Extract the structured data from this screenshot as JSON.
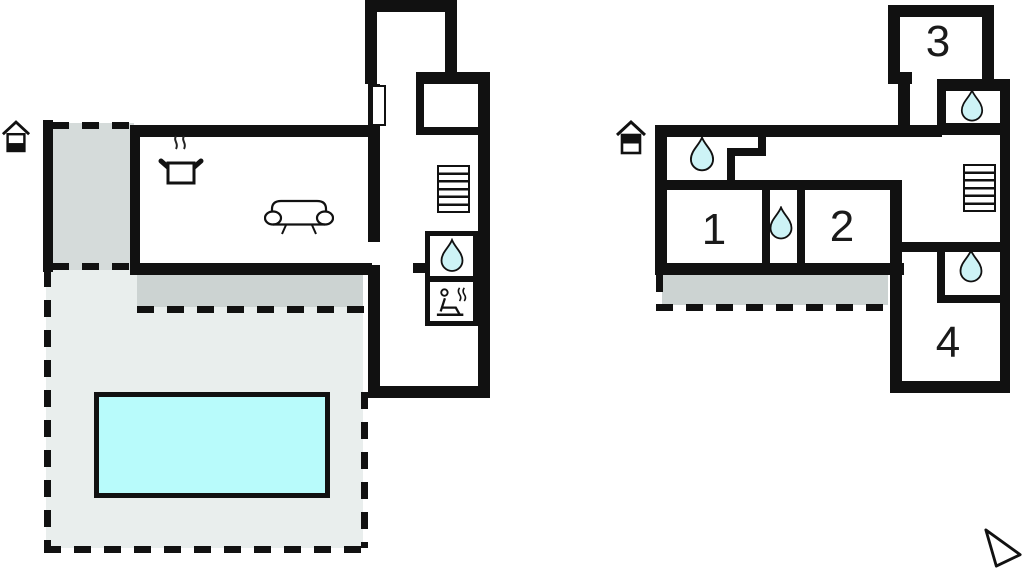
{
  "document": {
    "type": "vacation-house-floor-plan",
    "floors_shown": 2
  },
  "colors": {
    "wall": "#111111",
    "pool_fill": "#b8fbfb",
    "drop_fill": "#cdf3f6",
    "terrace_light": "#e9eeed",
    "terrace_dark": "#ccd3d2",
    "entry_gray": "#d5dbda",
    "background": "#ffffff"
  },
  "ground_floor": {
    "icons": {
      "level": "house-ground-floor-icon",
      "kitchen": "cooking-pot-icon",
      "living": "sofa-icon",
      "stairs": "stairs-icon",
      "bathroom": "water-drop-icon",
      "sauna": "sauna-icon"
    }
  },
  "first_floor": {
    "rooms": [
      {
        "label": "1"
      },
      {
        "label": "2"
      },
      {
        "label": "3"
      },
      {
        "label": "4"
      }
    ],
    "icons": {
      "level": "house-first-floor-icon",
      "stairs": "stairs-icon",
      "bathroom": "water-drop-icon"
    }
  },
  "compass": {
    "icon": "north-arrow-icon"
  }
}
